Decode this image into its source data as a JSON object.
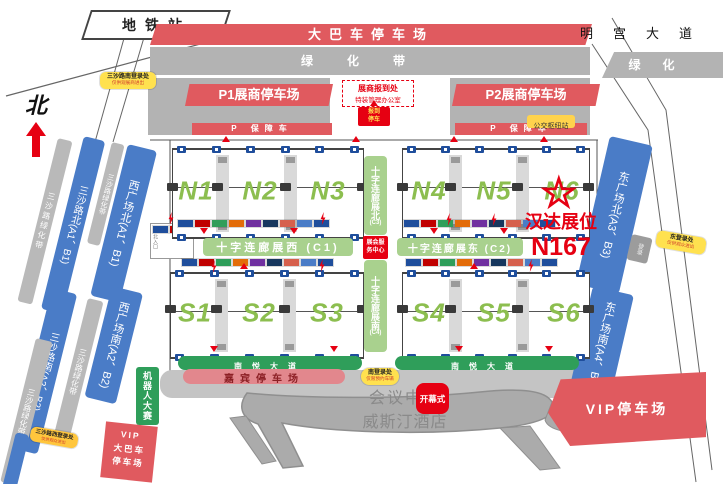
{
  "compass": {
    "north": "北"
  },
  "metro_station": "地铁站",
  "streets": {
    "bus_parking": "大巴车停车场",
    "minggong_avenue": "明宫大道",
    "green_belt": "绿化带",
    "green_belt_short": "绿化",
    "south_avenue_west": "南悦大道",
    "south_avenue_east": "南悦大道"
  },
  "north_area": {
    "p1_parking": "P1展商停车场",
    "p2_parking": "P2展商停车场",
    "registration_line1": "展商报到处",
    "registration_line2": "特装管理办公室",
    "registration_parking": "报到停车",
    "support_strip_west": "P 保障车",
    "support_strip_east": "P 保障车",
    "bus_hub": "公交枢纽站"
  },
  "west_bands": {
    "green_belt_1": "三沙路绿化带",
    "sansha_road_north": "三沙路北(A1、B1)",
    "green_belt_2": "三沙路绿化带",
    "west_plaza_north": "西广场北(A1、B1)",
    "sansha_road_south": "三沙路南(A2、B2)",
    "green_belt_3": "三沙路绿化带",
    "west_plaza_south": "西广场南(A2、B2)",
    "green_belt_4": "三沙路绿化带",
    "north_hall_entry": "北入口"
  },
  "east_bands": {
    "east_plaza_north": "东广场北(A3、B3)",
    "east_plaza_south": "东广场南(A4、B4)",
    "checkpoint": "登录"
  },
  "halls": {
    "north": [
      "N1",
      "N2",
      "N3",
      "N4",
      "N5",
      "N6"
    ],
    "south": [
      "S1",
      "S2",
      "S3",
      "S4",
      "S5",
      "S6"
    ]
  },
  "corridors": {
    "north_label": "十字连廊展北",
    "north_code": "(C3)",
    "south_label": "十字连廊展南",
    "south_code": "(C4)",
    "west_label": "十字连廊展西 (C1)",
    "east_label": "十字连廊展东 (C2)",
    "service_center": "展会服务中心"
  },
  "booth": {
    "name": "汉达展位",
    "number": "N167"
  },
  "south_area": {
    "guest_parking": "嘉宾停车场",
    "venue_line1": "会议中心",
    "venue_line2": "威斯汀酒店",
    "opening_ceremony": "开幕式",
    "vip_parking": "VIP停车场",
    "robot_contest": "机器人大赛",
    "vip_bus_line1": "VIP",
    "vip_bus_line2": "大巴车",
    "vip_bus_line3": "停车场"
  },
  "entrances": {
    "sansha_south_line1": "三沙路南登录处",
    "sansha_south_line2": "仅供观展商进出",
    "sansha_west_line1": "三沙路西登录处",
    "sansha_west_line2": "仅供观众进出",
    "east_line1": "东登录处",
    "east_line2": "仅供观众进出",
    "south_line1": "南登录处",
    "south_line2": "仅限预约车辆"
  },
  "colors": {
    "accent_red": "#e60012",
    "banner_red": "#e05a5f",
    "road_blue": "#4a7cc7",
    "hall_green": "#8cbe4f",
    "corridor_green": "#a9d18e",
    "deep_green": "#2f9e5a",
    "band_gray": "#b3b3b3",
    "label_yellow": "#ffe14f"
  },
  "decor": {
    "marker_palette": [
      "#1f4e9c",
      "#c00000",
      "#2f9e5a",
      "#e36c09",
      "#7030a0",
      "#17375e",
      "#d6604d",
      "#4a7cc7"
    ]
  }
}
